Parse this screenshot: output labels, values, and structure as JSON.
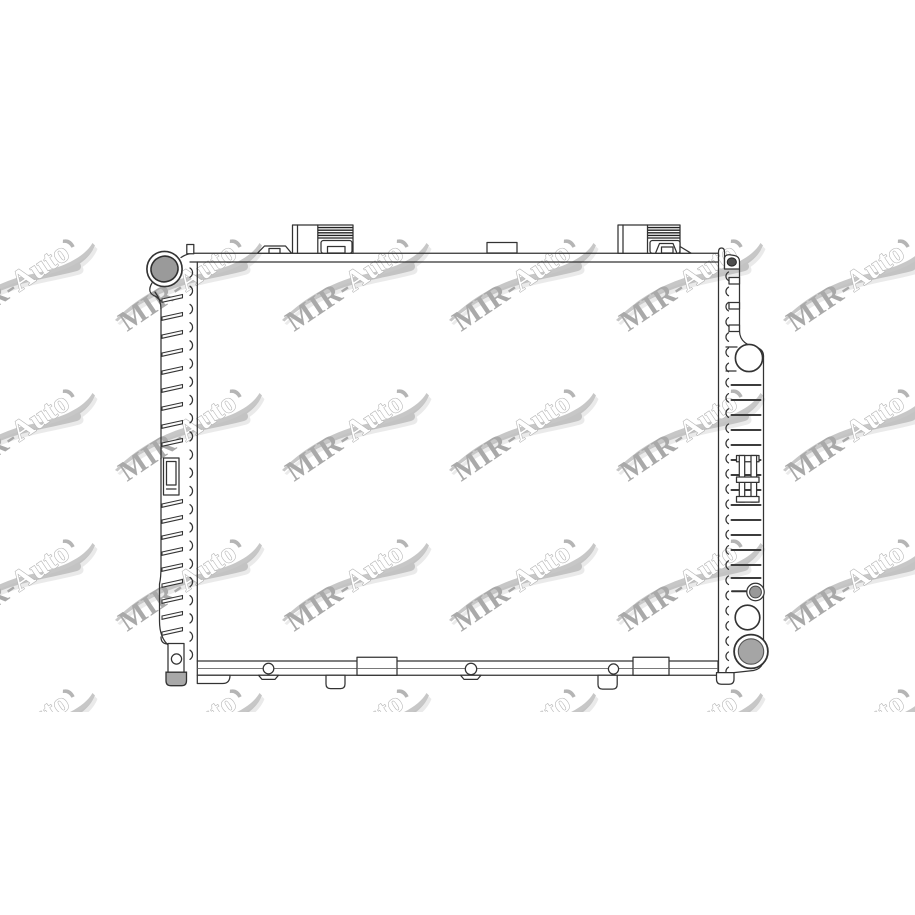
{
  "page": {
    "background": "#ffffff",
    "width": 915,
    "height": 915,
    "description_visible_subject": "radiator technical line drawing"
  },
  "watermark": {
    "text_primary": "MIR-",
    "text_secondary": "Auto",
    "full_text": "MIR-Auto",
    "color_primary": "#a9a9a9",
    "outline_fill": "#ffffff",
    "outline_stroke": "#b5b5b5",
    "swoosh_color": "#b9b9b9",
    "swoosh_highlight": "#e9e9e9",
    "font_size_px": 29,
    "rotation_deg": -34,
    "grid": {
      "column_anchors_x": [
        -40,
        127,
        294,
        461,
        628,
        795
      ],
      "row_anchors_y": [
        332,
        482,
        632,
        782
      ],
      "band_top": 219,
      "band_bottom": 712
    }
  },
  "drawing": {
    "line_color": "#333333",
    "line_color_soft": "#666666",
    "fills": {
      "filler_neck_port": "#9a9a9a",
      "clip_dot": "#4e4e4e",
      "small_port": "#999999",
      "large_port": "#a5a5a5",
      "foot_pad": "#a8a8a8"
    }
  }
}
